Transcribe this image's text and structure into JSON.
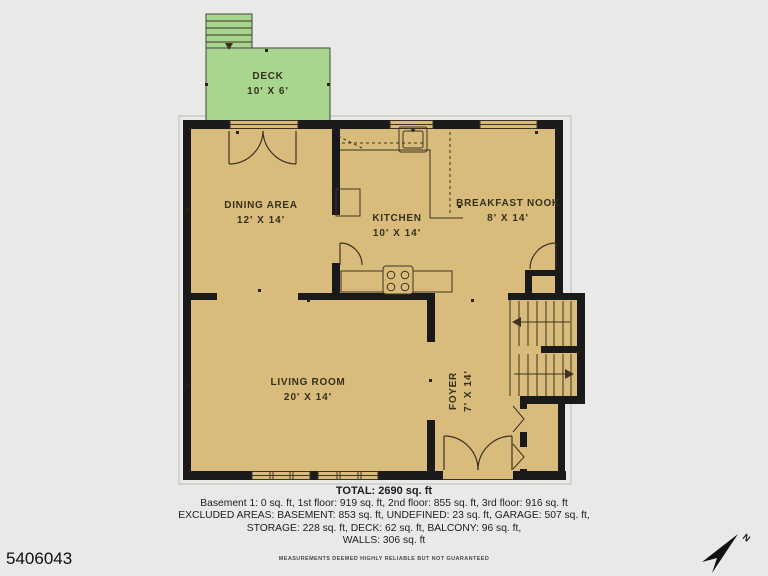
{
  "plan": {
    "colors": {
      "floor": "#d9bc7c",
      "deck": "#a8d68e",
      "wall": "#1a1a1a",
      "line": "#3c3322"
    },
    "rooms": [
      {
        "id": "deck",
        "name": "DECK",
        "dims": "10' X 6'"
      },
      {
        "id": "dining-area",
        "name": "DINING AREA",
        "dims": "12' X 14'"
      },
      {
        "id": "kitchen",
        "name": "KITCHEN",
        "dims": "10' X 14'"
      },
      {
        "id": "breakfast-nook",
        "name": "BREAKFAST NOOK",
        "dims": "8' X 14'"
      },
      {
        "id": "living-room",
        "name": "LIVING ROOM",
        "dims": "20' X 14'"
      },
      {
        "id": "foyer",
        "name": "FOYER",
        "dims": "7' X 14'"
      }
    ]
  },
  "summary": {
    "total": "TOTAL: 2690 sq. ft",
    "floors": "Basement 1: 0 sq. ft, 1st floor: 919 sq. ft, 2nd floor: 855 sq. ft, 3rd floor: 916 sq. ft",
    "excluded1": "EXCLUDED AREAS: BASEMENT: 853 sq. ft, UNDEFINED: 23 sq. ft, GARAGE: 507 sq. ft,",
    "excluded2": "STORAGE: 228 sq. ft, DECK: 62 sq. ft, BALCONY: 96 sq. ft,",
    "walls": "WALLS: 306 sq. ft",
    "disclaimer": "MEASUREMENTS DEEMED HIGHLY RELIABLE BUT NOT GUARANTEED"
  },
  "footer": {
    "listing_id": "5406043"
  },
  "compass": {
    "label": "N"
  }
}
